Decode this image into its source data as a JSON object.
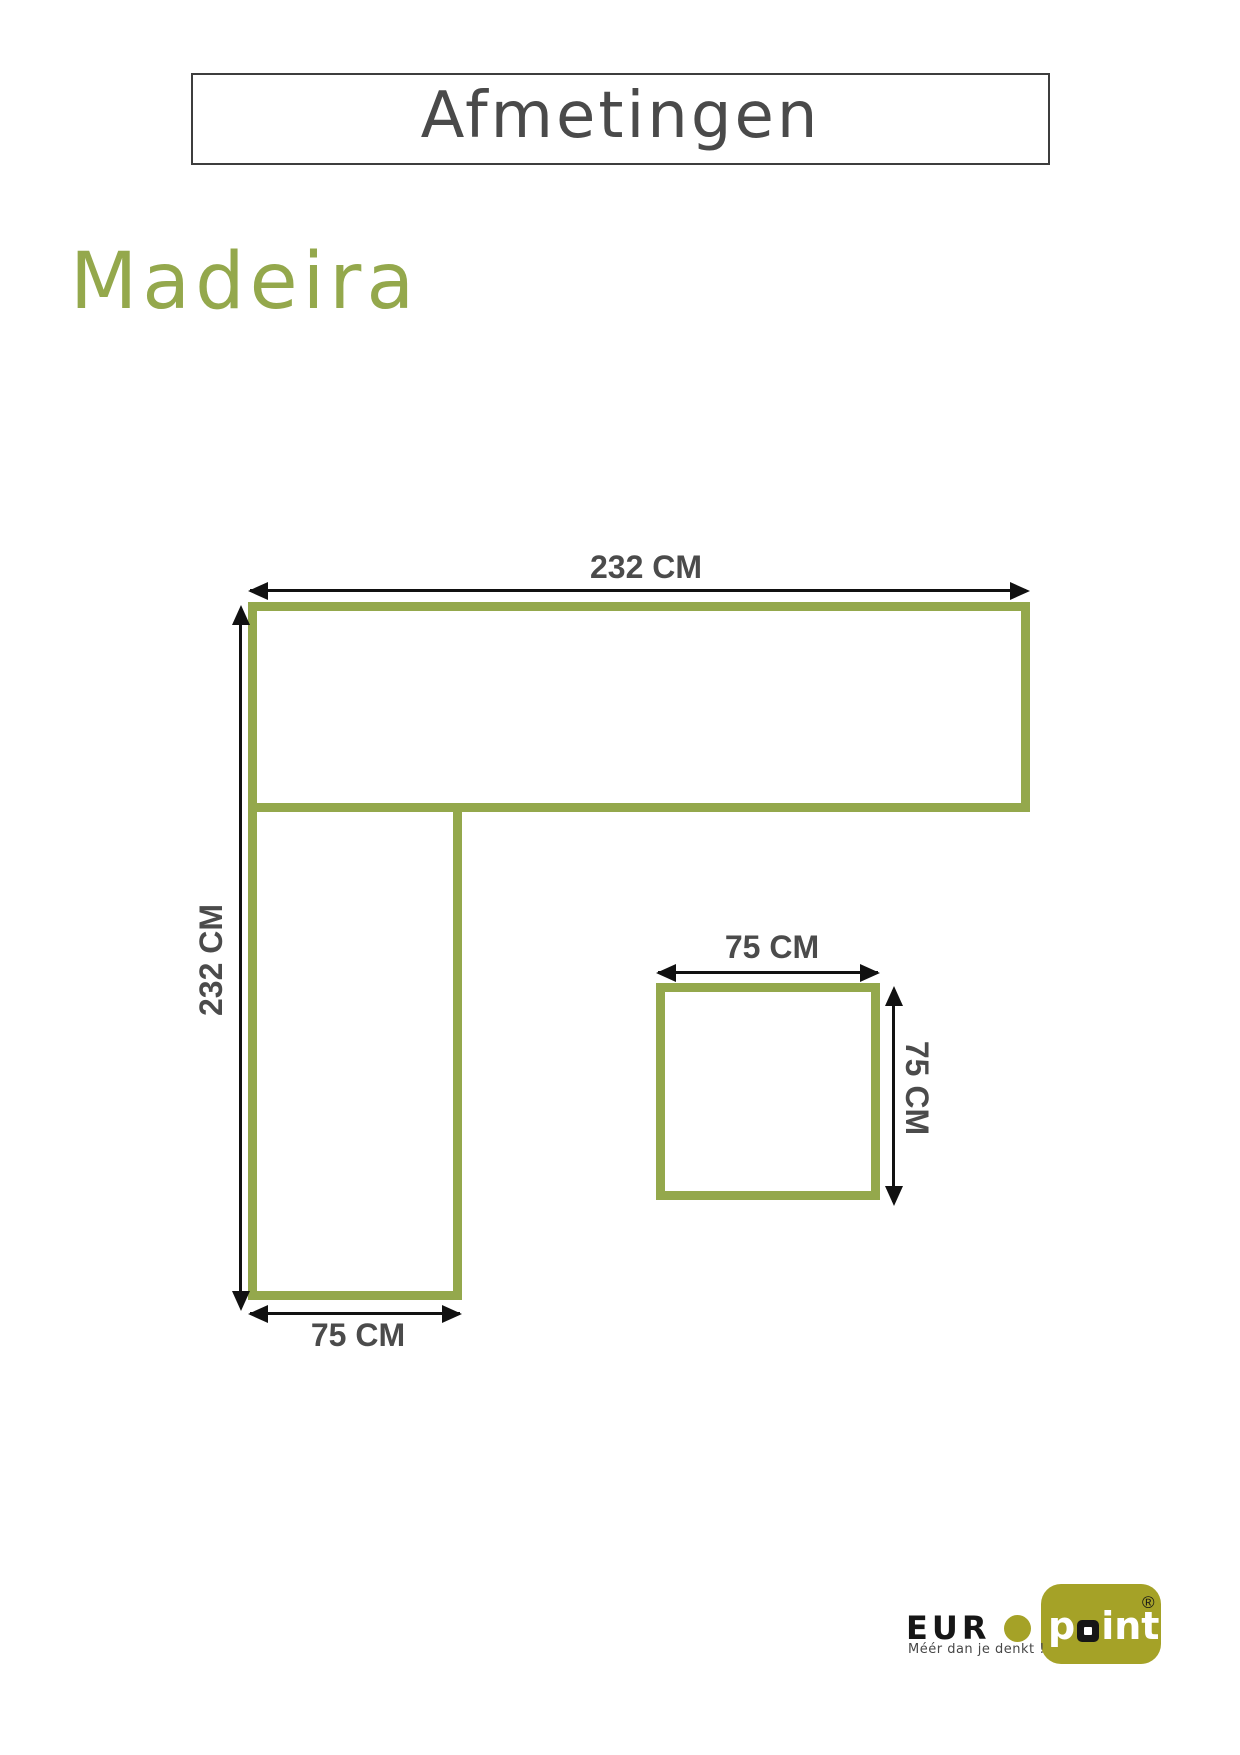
{
  "header": {
    "title": "Afmetingen"
  },
  "product": {
    "name": "Madeira"
  },
  "diagram": {
    "sofa": {
      "top_width_label": "232 CM",
      "left_height_label": "232 CM",
      "chaise_width_label": "75 CM"
    },
    "table": {
      "width_label": "75 CM",
      "height_label": "75 CM"
    },
    "colors": {
      "shape_outline": "#94a84c",
      "dimension_lines": "#111111",
      "label_text": "#4b4b4b"
    }
  },
  "logo": {
    "brand_prefix": "EUR",
    "brand_mid_letter": "p",
    "brand_suffix": "int",
    "registered_symbol": "®",
    "tagline": "Méér dan je denkt !",
    "colors": {
      "olive": "#a5a227",
      "dark": "#161616"
    }
  }
}
